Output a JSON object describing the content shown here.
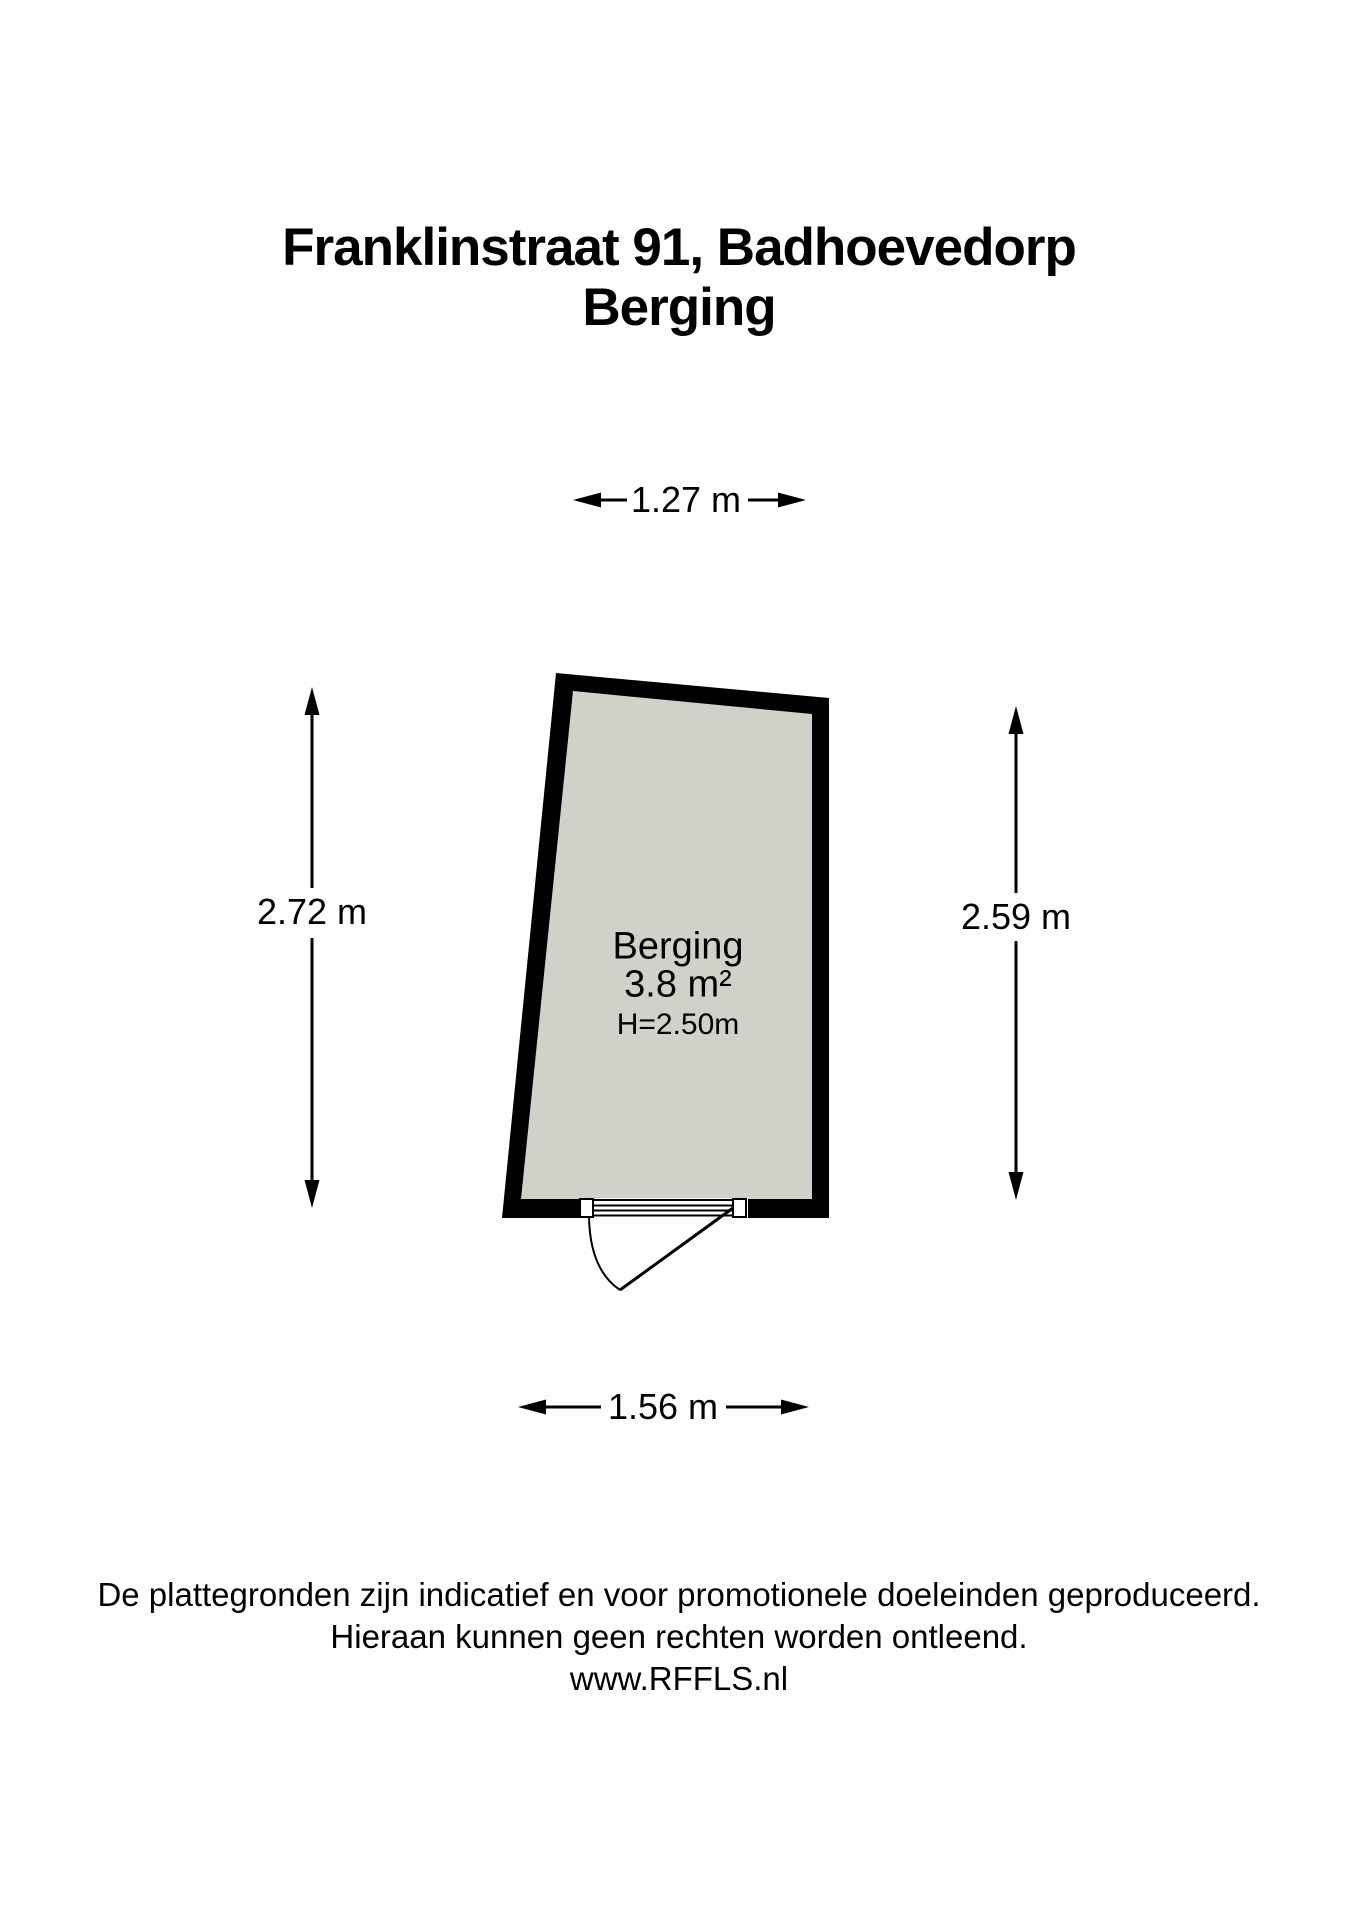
{
  "title": {
    "line1": "Franklinstraat 91, Badhoevedorp",
    "line2": "Berging"
  },
  "room": {
    "name": "Berging",
    "area": "3.8 m²",
    "ceiling_height": "H=2.50m"
  },
  "dimensions": {
    "top": "1.27 m",
    "left": "2.72 m",
    "right": "2.59 m",
    "bottom": "1.56 m"
  },
  "colors": {
    "wall": "#000000",
    "floor": "#d0d2ca",
    "line": "#1a1a1a",
    "background": "#ffffff"
  },
  "footer": {
    "line1": "De plattegronden zijn indicatief en voor promotionele doeleinden geproduceerd.",
    "line2": "Hieraan kunnen geen rechten worden ontleend.",
    "line3": "www.RFFLS.nl"
  }
}
